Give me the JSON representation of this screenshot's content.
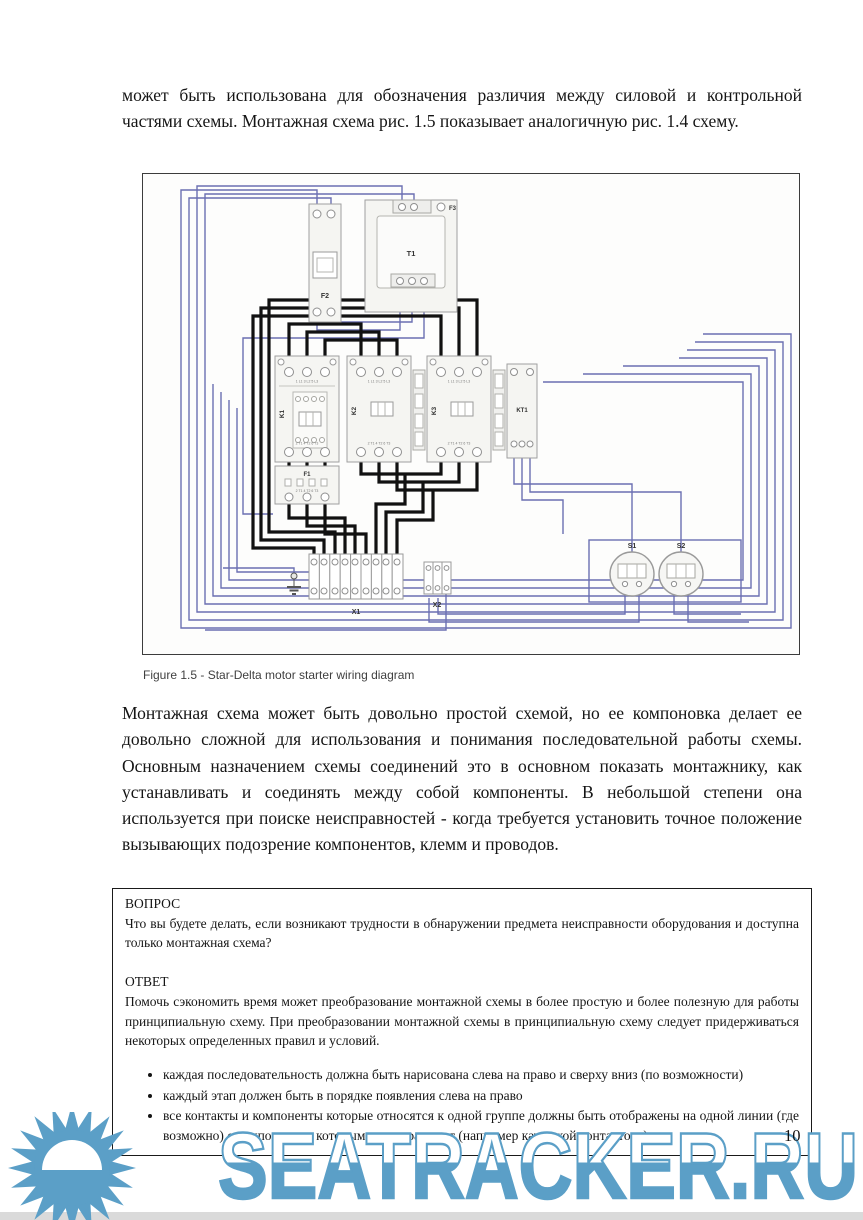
{
  "document": {
    "paragraph_top": "может быть использована для обозначения различия между силовой и контрольной частями схемы. Монтажная схема рис. 1.5 показывает аналогичную рис. 1.4 схему.",
    "figure_caption": "Figure 1.5 - Star-Delta motor starter wiring diagram",
    "paragraph_middle": "Монтажная схема может быть довольно простой схемой, но ее компоновка делает ее довольно сложной для использования и понимания последовательной работы схемы. Основным назначением схемы соединений это в основном показать монтажнику, как устанавливать и соединять между собой компоненты. В небольшой степени она используется при поиске неисправностей - когда требуется установить точное положение вызывающих подозрение компонентов, клемм и проводов.",
    "page_number": "10"
  },
  "qa_box": {
    "question_label": "ВОПРОС",
    "question_text": "Что вы будете делать, если возникают трудности в обнаружении предмета неисправности оборудования и доступна только монтажная схема?",
    "answer_label": "ОТВЕТ",
    "answer_text": "Помочь сэкономить время может преобразование монтажной схемы в более простую и более полезную для работы принципиальную схему. При преобразовании монтажной схемы в принципиальную схему следует придерживаться некоторых определенных правил и условий.",
    "bullets": [
      "каждая последовательность должна быть нарисована слева на право и сверху вниз (по возможности)",
      "каждый этап должен быть в порядке появления слева на право",
      "все контакты и компоненты которые относятся к одной группе должны быть отображены на одной линии (где возможно) с компонентом которым они управляют (например катушкой контактора)"
    ]
  },
  "diagram": {
    "labels": {
      "f2": "F2",
      "t1": "T1",
      "f3": "F3",
      "k1": "K1",
      "k2": "K2",
      "k3": "K3",
      "kt1": "KT1",
      "f1": "F1",
      "x1": "X1",
      "x2": "X2",
      "s1": "S1",
      "s2": "S2",
      "contactor_top_terminals": "1 L1 3 L2 5 L3",
      "contactor_bottom_terminals": "2 T1 4 T2 6 T3"
    },
    "wire_colors": {
      "control_wire": "#6b6fb2",
      "power_wire": "#111111"
    }
  },
  "watermark": {
    "text": "SEATRACKER.RU",
    "color": "#5b9fc7"
  }
}
